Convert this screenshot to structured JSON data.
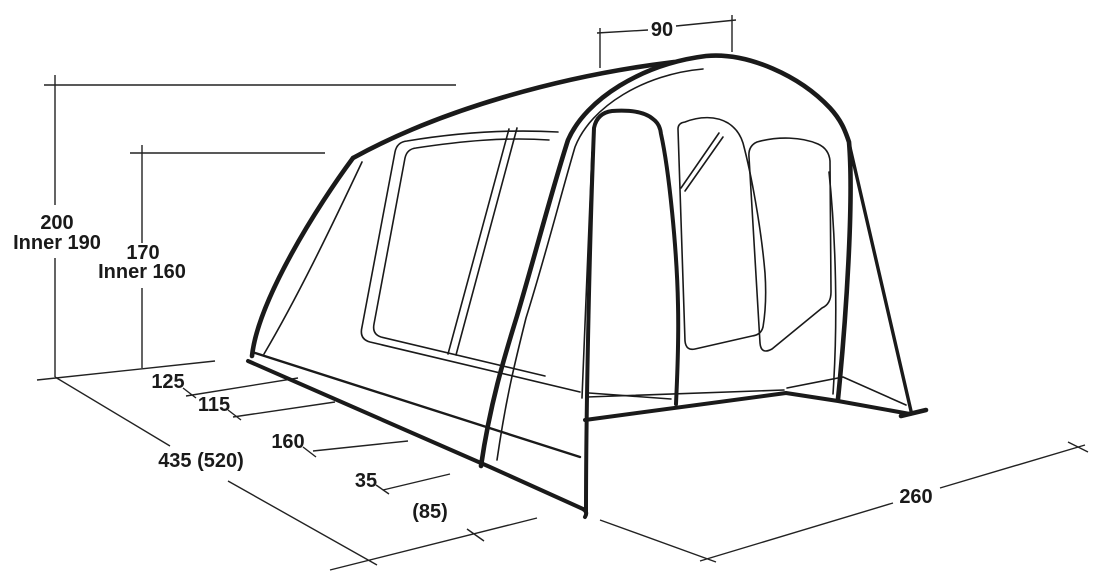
{
  "diagram": {
    "subject": "tent-dimension-diagram",
    "colors": {
      "background": "#ffffff",
      "line": "#1a1a1a",
      "dimension": "#222222",
      "text": "#1a1a1a"
    },
    "dims": {
      "height": {
        "value": "200",
        "inner": "Inner 190"
      },
      "mid_height": {
        "value": "170",
        "inner": "Inner 160"
      },
      "top_width": {
        "value": "90"
      },
      "segments": [
        {
          "value": "125"
        },
        {
          "value": "115"
        },
        {
          "value": "160"
        },
        {
          "value": "35"
        },
        {
          "value": "(85)"
        }
      ],
      "total_length": {
        "value": "435 (520)"
      },
      "front_width": {
        "value": "260"
      }
    }
  }
}
